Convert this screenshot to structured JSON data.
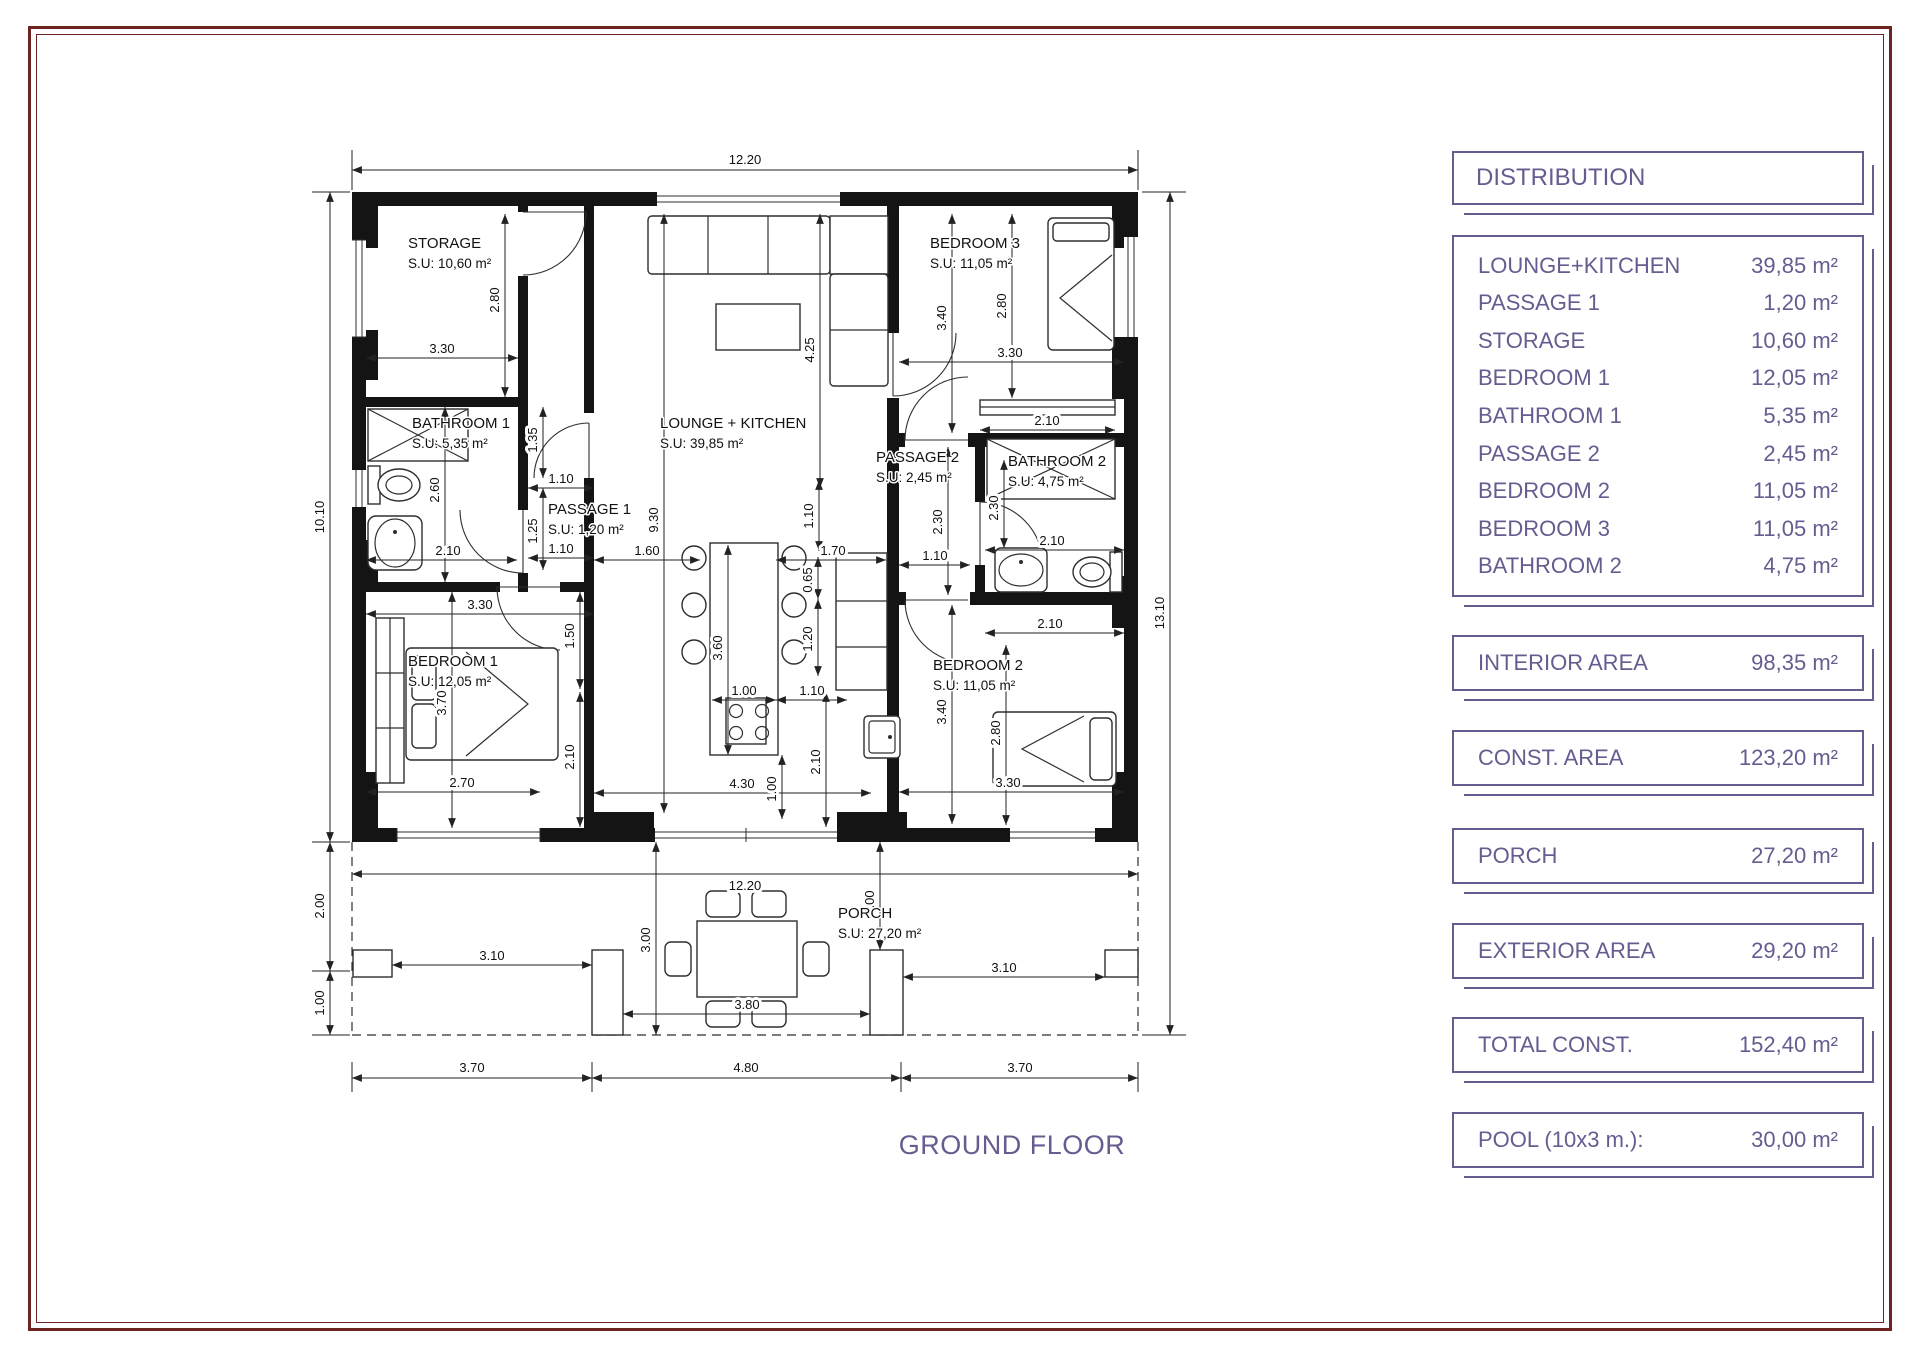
{
  "panel": {
    "accent": "#675b90",
    "title": "DISTRIBUTION",
    "rooms": [
      {
        "label": "LOUNGE+KITCHEN",
        "area": "39,85 m²"
      },
      {
        "label": "PASSAGE 1",
        "area": "1,20 m²"
      },
      {
        "label": "STORAGE",
        "area": "10,60 m²"
      },
      {
        "label": "BEDROOM 1",
        "area": "12,05 m²"
      },
      {
        "label": "BATHROOM 1",
        "area": "5,35 m²"
      },
      {
        "label": "PASSAGE 2",
        "area": "2,45 m²"
      },
      {
        "label": "BEDROOM 2",
        "area": "11,05 m²"
      },
      {
        "label": "BEDROOM 3",
        "area": "11,05 m²"
      },
      {
        "label": "BATHROOM 2",
        "area": "4,75 m²"
      }
    ],
    "totals": [
      {
        "label": "INTERIOR AREA",
        "value": "98,35 m²"
      },
      {
        "label": "CONST. AREA",
        "value": "123,20 m²"
      },
      {
        "label": "PORCH",
        "value": "27,20 m²"
      },
      {
        "label": "EXTERIOR AREA",
        "value": "29,20 m²"
      },
      {
        "label": "TOTAL CONST.",
        "value": "152,40 m²"
      },
      {
        "label": "POOL (10x3 m.):",
        "value": "30,00 m²"
      }
    ]
  },
  "plan": {
    "floor_title": "GROUND FLOOR",
    "rooms": {
      "storage": {
        "name": "STORAGE",
        "su": "S.U: 10,60 m²"
      },
      "lounge": {
        "name": "LOUNGE + KITCHEN",
        "su": "S.U: 39,85 m²"
      },
      "bedroom3": {
        "name": "BEDROOM 3",
        "su": "S.U: 11,05 m²"
      },
      "bathroom1": {
        "name": "BATHROOM 1",
        "su": "S.U: 5,35 m²"
      },
      "passage1": {
        "name": "PASSAGE 1",
        "su": "S.U: 1,20 m²"
      },
      "passage2": {
        "name": "PASSAGE 2",
        "su": "S.U: 2,45 m²"
      },
      "bathroom2": {
        "name": "BATHROOM 2",
        "su": "S.U: 4,75 m²"
      },
      "bedroom1": {
        "name": "BEDROOM 1",
        "su": "S.U: 12,05 m²"
      },
      "bedroom2": {
        "name": "BEDROOM 2",
        "su": "S.U: 11,05 m²"
      },
      "porch": {
        "name": "PORCH",
        "su": "S.U: 27,20 m²"
      }
    },
    "dims": {
      "v1220": "12.20",
      "v1010": "10.10",
      "v1310": "13.10",
      "v200": "2.00",
      "v100": "1.00",
      "v370": "3.70",
      "v480": "4.80",
      "v310": "3.10",
      "v380": "3.80",
      "v300": "3.00",
      "v330": "3.30",
      "v280": "2.80",
      "v260": "2.60",
      "v210": "2.10",
      "v135": "1.35",
      "v110": "1.10",
      "v125": "1.25",
      "v930": "9.30",
      "v425": "4.25",
      "v160": "1.60",
      "v170": "1.70",
      "v065": "0.65",
      "v120": "1.20",
      "v360": "3.60",
      "v430": "4.30",
      "v230": "2.30",
      "v340": "3.40",
      "v270": "2.70",
      "v150": "1.50"
    }
  }
}
